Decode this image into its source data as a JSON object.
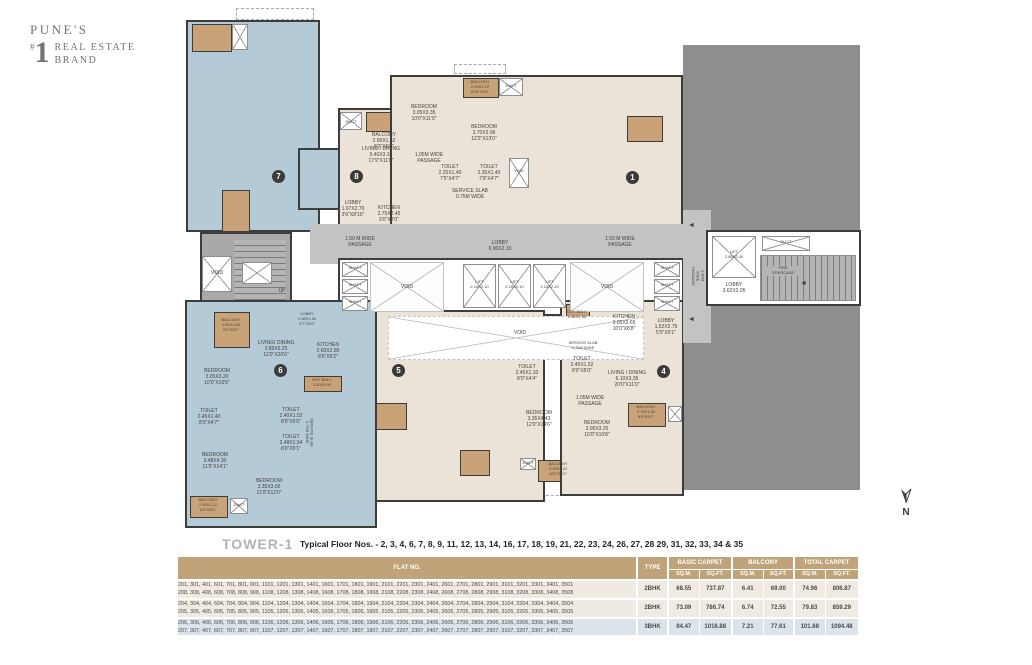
{
  "logo": {
    "line1": "PUNE'S",
    "hash": "#",
    "number": "1",
    "line2": "REAL ESTATE",
    "line3": "BRAND"
  },
  "compass": {
    "label": "N"
  },
  "plan": {
    "badges": {
      "u1": "1",
      "u4": "4",
      "u5": "5",
      "u6": "6",
      "u7": "7",
      "u8": "8"
    },
    "colors": {
      "unit_blue": "#b5cad7",
      "unit_cream": "#ebe3d7",
      "balcony_tan": "#c9a377",
      "corridor_gray": "#c3c3c3",
      "mass_gray": "#8e8e8e",
      "wall": "#3d3d3d"
    },
    "labels": {
      "shaft": "SHAFT",
      "void": "VOID",
      "duct": "DUCT",
      "up": "UP",
      "arrow_left": "◄",
      "lift_c": "LIFT\n2.10X2.10",
      "lift_r": "LIFT\n2.85X2.40",
      "lobby_central": "LOBBY\n6.90X2.10",
      "lobby_r": "LOBBY\n3.62X2.05",
      "fire_stair": "FIRE\nSTAIRCASE",
      "passage150": "1.50 M WIDE\nPASSAGE",
      "passage150_v": "1.50M\nWIDE\nPASSAGE",
      "passage105": "1.05M WIDE\nPASSAGE",
      "service_slab": "SERVICE SLAB\n0.75M WIDE",
      "balcony8": "BALCONY\n2.50X1.52\n8'2\"X5'0\"",
      "living8": "LIVING / DINING\n5.40X3.35\n17'9\"X11'0\"",
      "lobby8": "LOBBY\n1.07X2.70\n3'6\"X8'10\"",
      "kitchen8": "KITCHEN\n2.75X2.45\n9'0\"X8'0\"",
      "balcony_top": "BALCONY\n2.20X1.22\n6'10\"X4'0\"",
      "bedroom_t1": "BEDROOM\n3.05X3.35\n10'0\"X11'0\"",
      "bedroom_t2": "BEDROOM\n3.70X3.96\n12'2\"X13'0\"",
      "toilet_t1": "TOILET\n2.25X1.40\n7'5\"X4'7\"",
      "toilet_t2": "TOILET\n2.35X1.40\n7'9\"X4'7\"",
      "drybalc4": "DRY BALC\n0.86X1.98",
      "kitchen4": "KITCHEN\n3.05X2.65\n10'0\"X8'8\"",
      "lobby4": "LOBBY\n1.52X2.76\n5'0\"X9'1\"",
      "toilet4": "TOILET\n2.45X1.52\n8'0\"X5'0\"",
      "living4": "LIVING / DINING\n6.10X3.35\n20'0\"X11'0\"",
      "toilet5": "TOILET\n2.45X1.32\n8'0\"X4'4\"",
      "bedroom_b1": "BEDROOM\n3.35X4.43\n12'0\"X14'6\"",
      "bedroom_b2": "BEDROOM\n3.05X3.25\n10'0\"X10'8\"",
      "balcony4": "BALCONY\n2.75X1.52\n9'0\"X5'0\"",
      "balcony_b": "BALCONY\n3.10X1.22\n10'2\"X4'0\"",
      "balcony6a": "BALCONY\n1.52X2.80\n5'0\"X9'2\"",
      "living6": "LIVING/ DINING\n3.85X6.25\n12'0\"X20'6\"",
      "lobby6": "LOBBY\n1.08X1.52\n3'7\"X5'0\"",
      "kitchen6": "KITCHEN\n2.60X2.80\n8'6\"X9'2\"",
      "drybalc6": "DRY BALC\n2.60X0.90",
      "bedroom6a": "BEDROOM\n3.05X3.20\n10'0\"X10'6\"",
      "toilet6a": "TOILET\n2.45X1.40\n8'0\"X4'7\"",
      "toilet6b": "TOILET\n2.40X1.52\n8'0\"X5'0\"",
      "toilet6c": "TOILET\n2.48X1.54\n8'0\"X5'1\"",
      "bedroom6b": "BEDROOM\n3.48X4.30\n11'5\"X14'1\"",
      "bedroom6c": "BEDROOM\n3.35X3.65\n11'0\"X12'0\"",
      "balcony6b": "BALCONY\n2.45X1.22\n8'0\"X4'0\""
    }
  },
  "footer": {
    "tower": "TOWER-1",
    "floors": "Typical Floor Nos. - 2, 3, 4, 6, 7, 8, 9, 11, 12, 13, 14, 16, 17, 18, 19, 21, 22, 23, 24, 26, 27, 28 29, 31, 32, 33, 34 & 35",
    "table": {
      "headers": {
        "flat_no": "FLAT NO.",
        "type": "TYPE",
        "basic": "BASIC CARPET",
        "balcony": "BALCONY",
        "total": "TOTAL CARPET",
        "sqm": "SQ.M.",
        "sqft": "SQ.FT."
      },
      "rows": [
        {
          "flats": "201, 301, 401, 601, 701, 801, 901, 1101, 1201, 1301, 1401, 1601, 1701, 1801, 1901, 2101, 2201, 2301, 2401, 2601, 2701, 2801, 2901, 3101, 3201, 3301, 3401, 3501\n208, 308, 408, 608, 708, 808, 908, 1108, 1208, 1308, 1408, 1608, 1708, 1808, 1908, 2108, 2208, 2308, 2408, 2608, 2708, 2808, 2908, 3108, 3208, 3308, 3408, 3508",
          "type": "2BHK",
          "basic_sqm": "68.55",
          "basic_sqft": "737.87",
          "bal_sqm": "6.41",
          "bal_sqft": "69.00",
          "total_sqm": "74.96",
          "total_sqft": "806.87"
        },
        {
          "flats": "204, 304, 404, 604, 704, 804, 904, 1104, 1204, 1304, 1404, 1604, 1704, 1804, 1904, 2104, 2204, 2304, 2404, 2604, 2704, 2804, 2904, 3104, 3204, 3304, 3404, 3504\n205, 305, 405, 605, 705, 805, 905, 1105, 1205, 1305, 1405, 1605, 1705, 1805, 1905, 2105, 2205, 2305, 2405, 2605, 2705, 2805, 2905, 3105, 3205, 3305, 3405, 3505",
          "type": "2BHK",
          "basic_sqm": "73.09",
          "basic_sqft": "786.74",
          "bal_sqm": "6.74",
          "bal_sqft": "72.55",
          "total_sqm": "79.83",
          "total_sqft": "859.29"
        },
        {
          "flats": "206, 306, 406, 606, 706, 806, 906, 1106, 1206, 1306, 1406, 1606, 1706, 1806, 1906, 2106, 2206, 2306, 2406, 2606, 2706, 2806, 2906, 3106, 3206, 3306, 3406, 3506\n207, 307, 407, 607, 707, 807, 907, 1107, 1207, 1307, 1407, 1607, 1707, 1807, 1907, 2107, 2207, 2307, 2407, 2607, 2707, 2807, 2907, 3107, 3207, 3307, 3407, 3507",
          "type": "3BHK",
          "basic_sqm": "94.47",
          "basic_sqft": "1016.88",
          "bal_sqm": "7.21",
          "bal_sqft": "77.61",
          "total_sqm": "101.68",
          "total_sqft": "1094.48"
        }
      ]
    }
  }
}
